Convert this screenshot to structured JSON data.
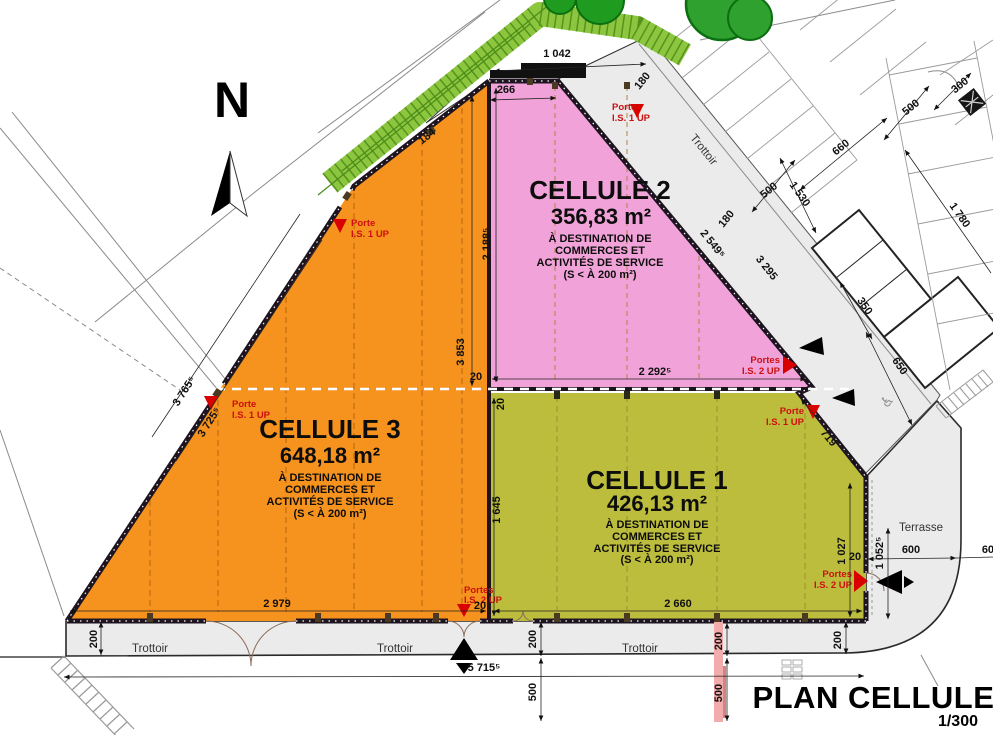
{
  "title": {
    "text": "PLAN CELLULES",
    "scale": "1/300"
  },
  "north": {
    "label": "N"
  },
  "labels": {
    "trottoir": "Trottoir",
    "terrasse": "Terrasse"
  },
  "doors": {
    "porte": "Porte",
    "is1": "I.S. 1 UP",
    "portes": "Portes",
    "is2": "I.S. 2 UP"
  },
  "dest": {
    "l1": "À DESTINATION DE",
    "l2": "COMMERCES ET",
    "l3": "ACTIVITÉS DE SERVICE",
    "l4": "(S < À 200 m²)"
  },
  "cells": {
    "c1": {
      "name": "CELLULE 1",
      "area": "426,13 m²"
    },
    "c2": {
      "name": "CELLULE 2",
      "area": "356,83 m²"
    },
    "c3": {
      "name": "CELLULE 3",
      "area": "648,18 m²"
    }
  },
  "dims": {
    "canopy": "1 042",
    "pink_inner": "266",
    "orange_top": "184",
    "gap_top": "180",
    "gap_mid": "180",
    "pink_left": "2 188⁵",
    "pink_diag": "2 549⁵",
    "walkway_diag": "3 295",
    "orange_right": "3 853",
    "edge_outer": "3 765⁵",
    "edge_inner": "3 725⁵",
    "pink_bottom": "2 292⁵",
    "wall_h": "20",
    "wall_v": "20",
    "wall_bottom": "20",
    "wall_right": "20",
    "olive_left": "1 645",
    "olive_diag": "719",
    "olive_right": "1 027",
    "olive_right_outer": "1 052⁵",
    "terrasse_w": "600",
    "olive_bottom": "2 660",
    "orange_bottom": "2 979",
    "total": "5 715⁵",
    "sidewalk": "200",
    "offset": "500",
    "p300": "300",
    "p500a": "500",
    "p500b": "500",
    "p660": "660",
    "p1530": "1 530",
    "p1780": "1 780",
    "p350": "350",
    "p650": "650"
  },
  "icons": {
    "handicap": "♿"
  },
  "colors": {
    "cell1": "#BCBD3C",
    "cell2": "#F1A3D9",
    "cell3": "#F6921E",
    "walkway": "#EBEBEB",
    "hedge": "#8CC63F",
    "tree": "#2EA12E",
    "wall": "#1D1420",
    "marker_red": "#D90000"
  }
}
